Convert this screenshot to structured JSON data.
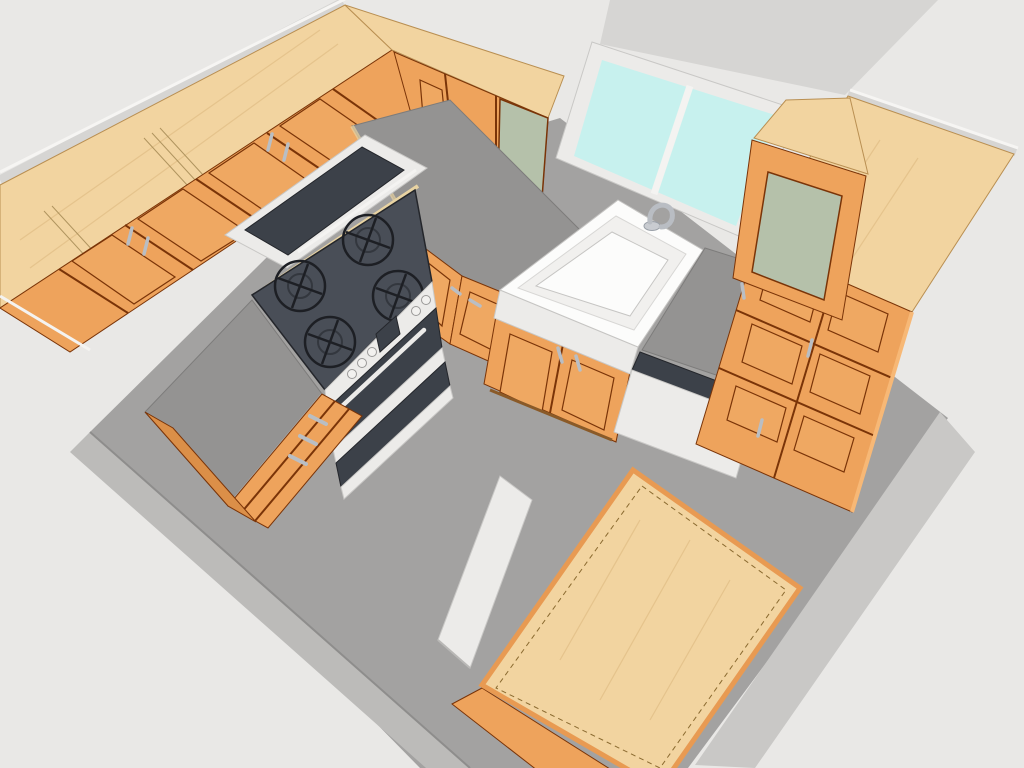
{
  "scene": {
    "kind": "3d-kitchen-model-render",
    "view": "overhead-perspective",
    "objects": [
      {
        "name": "left-wall-cabinets",
        "material": "wood"
      },
      {
        "name": "microwave",
        "material": "black-stainless"
      },
      {
        "name": "range-stove",
        "burners": 4,
        "material": "black-white"
      },
      {
        "name": "left-counter-with-drawers"
      },
      {
        "name": "corner-counter-base-cabinet"
      },
      {
        "name": "upper-cabinets-glass-door"
      },
      {
        "name": "window",
        "panes": 2
      },
      {
        "name": "farmhouse-sink-with-faucet"
      },
      {
        "name": "sink-base-cabinet"
      },
      {
        "name": "dishwasher"
      },
      {
        "name": "right-counter"
      },
      {
        "name": "right-glass-upper-cabinet"
      },
      {
        "name": "tall-pantry-cabinet"
      },
      {
        "name": "kitchen-island",
        "top": "butcher-block"
      },
      {
        "name": "white-cabinet-box"
      },
      {
        "name": "gray-floor-slab"
      }
    ]
  },
  "colors": {
    "bg": "#e9e8e6",
    "wall": "#d6d5d3",
    "wall-highlight": "#f6f5f3",
    "floor": "#a3a2a1",
    "floor-band": "#bcbbb9",
    "floor-band-right": "#c9c8c6",
    "wood-top": "#f2d4a0",
    "wood-grain": "#e0be85",
    "wood-edge": "#b98f52",
    "wood-face": "#eea35c",
    "wood-face-shade": "#db8f48",
    "wood-panel": "#efa862",
    "wood-seam": "#7a3408",
    "counter": "#949392",
    "counter-edge": "#7d7c7b",
    "counter-tan": "#e8d3a2",
    "stove-top": "#494e57",
    "burner": "#1d1f24",
    "appliance-dark": "#3c4149",
    "trim-white": "#ecebe9",
    "sink-white": "#fcfcfb",
    "glass-cyan": "#c7f1ee",
    "glass-sage": "#b5c1aa",
    "handle": "#b9bec4",
    "faucet": "#b9bdc3",
    "island-rim": "#e89a52"
  }
}
